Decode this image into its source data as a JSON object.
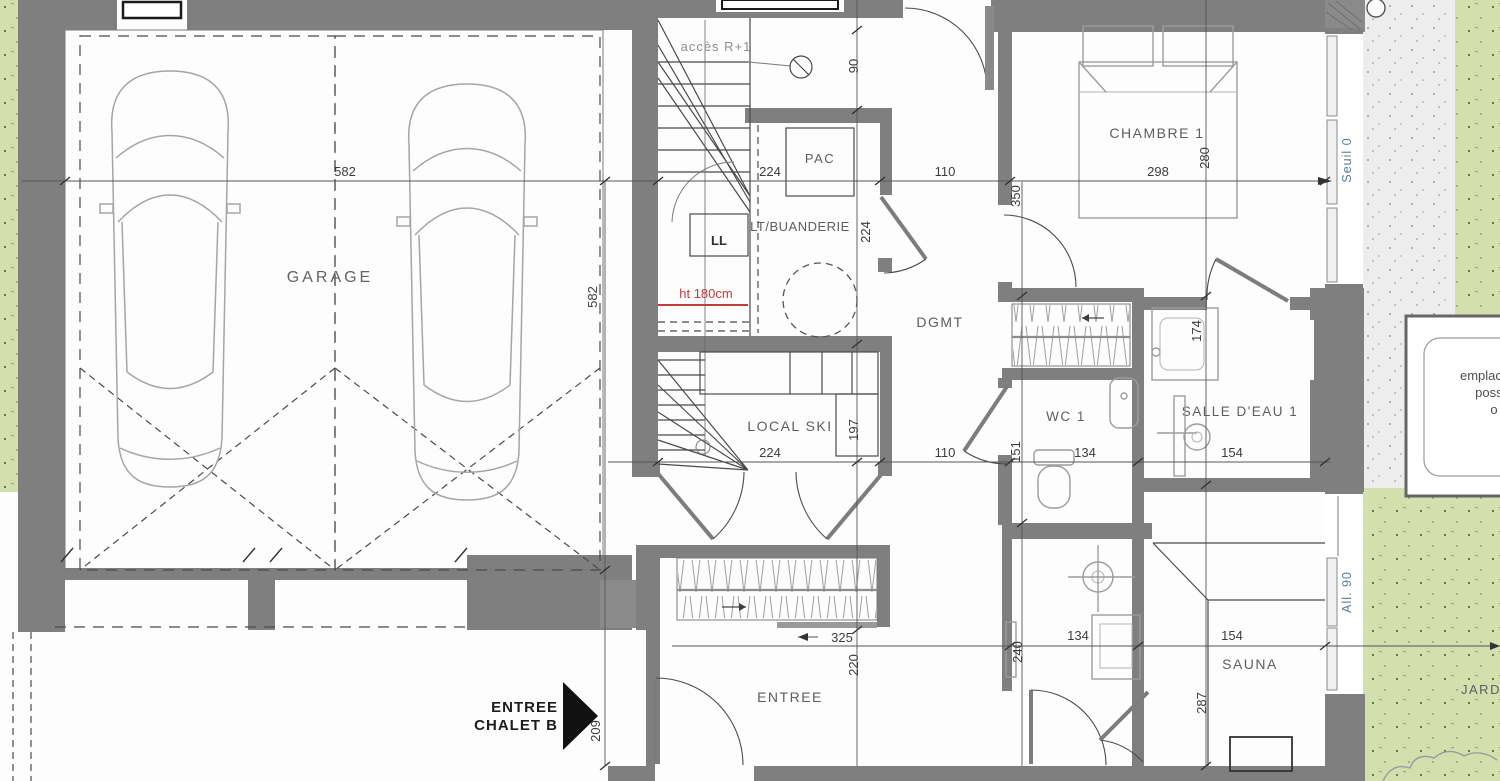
{
  "rooms": {
    "garage": "GARAGE",
    "chambre1": "CHAMBRE 1",
    "dgmt": "DGMT",
    "wc1": "WC 1",
    "salle_deau1": "SALLE D'EAU 1",
    "local_ski": "LOCAL SKI",
    "buanderie": "LT/BUANDERIE",
    "pac": "PAC",
    "lave_linge": "LL",
    "sauna": "SAUNA",
    "entree": "ENTREE",
    "jardin": "JARDIN"
  },
  "annotations": {
    "acces_r1": "accès R+1",
    "headroom": "ht 180cm",
    "seuil": "Seuil 0",
    "allege": "All. 90",
    "entrance_line1": "ENTREE",
    "entrance_line2": "CHALET B",
    "note_line1": "emplacement",
    "note_line2": "possible",
    "note_line3": "o"
  },
  "dims": {
    "garage_width": "582",
    "garage_depth": "582",
    "stair_width": "224",
    "buanderie_depth": "224",
    "localski_width": "224",
    "hall_width_top": "110",
    "hall_width_mid": "110",
    "stair_top": "90",
    "chambre_width": "298",
    "chambre_depth": "280",
    "chambre_left": "350",
    "sde_top": "174",
    "sde_width": "154",
    "sauna_width": "154",
    "wc_width": "134",
    "shower_width": "134",
    "wc_depth": "151",
    "localski_depth": "197",
    "entree_width": "325",
    "entree_depth": "220",
    "shower_depth": "240",
    "sauna_depth": "287",
    "entry_side": "209"
  },
  "colors": {
    "wall_gray": "#7f7f7f",
    "line_dark": "#3d3d3d",
    "furniture_gray": "#9c9c9c",
    "lawn_green": "#d3dfad",
    "terrace_gray": "#ededed",
    "alert_red": "#c23b3b",
    "level_label_blue": "#5a7a96"
  }
}
